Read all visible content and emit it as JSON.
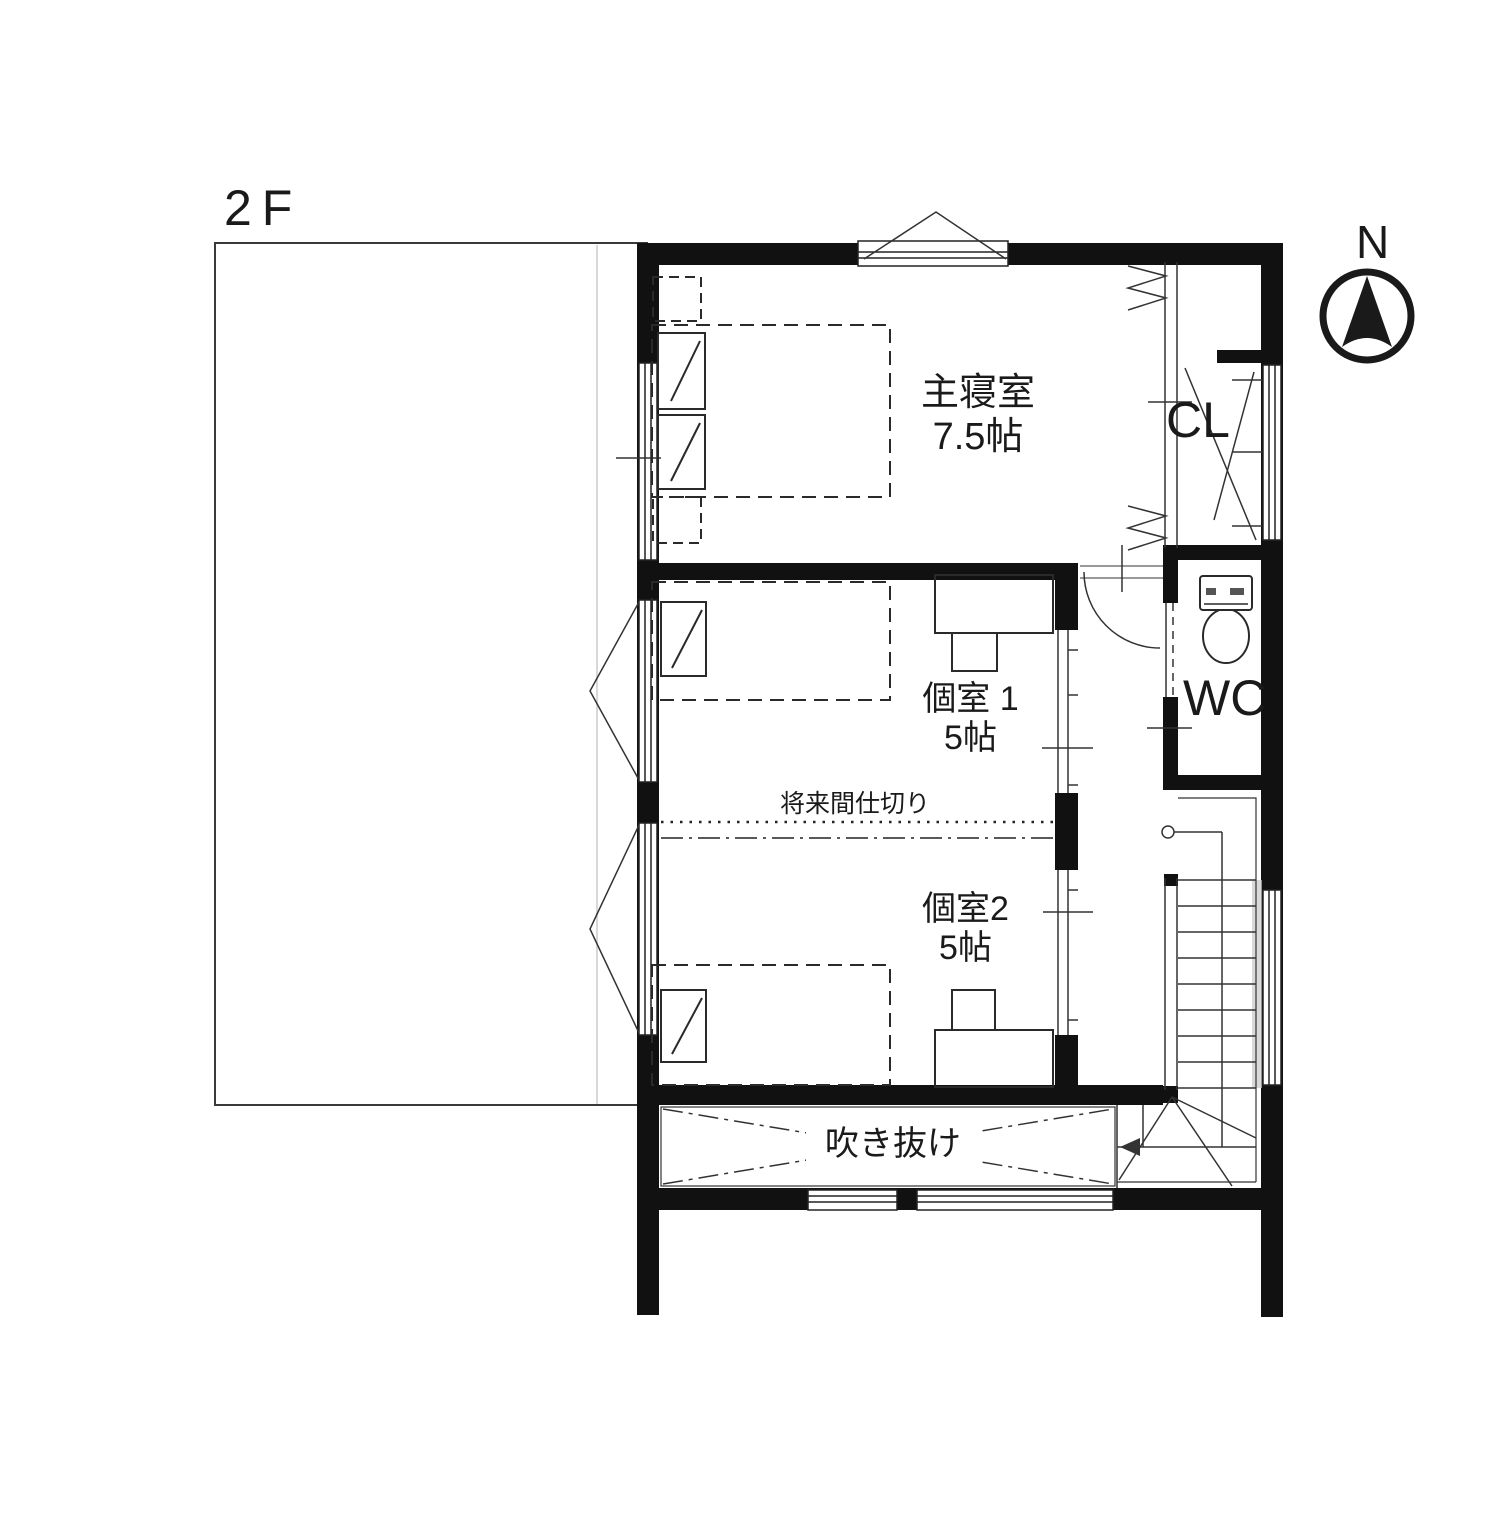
{
  "floor_label": "2F",
  "compass": {
    "north_label": "N"
  },
  "rooms": {
    "master_bedroom": {
      "name": "主寝室",
      "size": "7.5帖"
    },
    "room1": {
      "name": "個室 1",
      "size": "5帖"
    },
    "room2": {
      "name": "個室2",
      "size": "5帖"
    },
    "closet": {
      "abbr": "CL"
    },
    "toilet": {
      "abbr": "WC"
    }
  },
  "annotations": {
    "future_partition": "将来間仕切り",
    "void": "吹き抜け"
  },
  "colors": {
    "wall": "#111111",
    "line": "#333333",
    "background": "#ffffff",
    "shading": "#c9c9c9"
  }
}
